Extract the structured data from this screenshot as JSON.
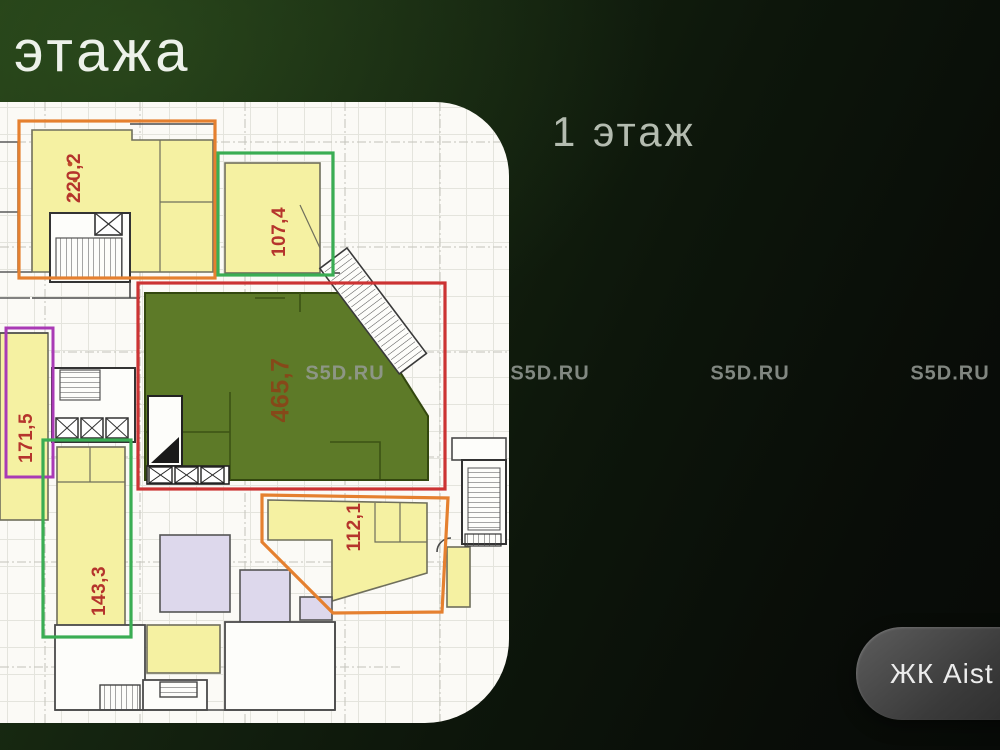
{
  "slide": {
    "title": "этажа",
    "floor_heading": "1 этаж"
  },
  "watermark": {
    "text": "S5D.RU"
  },
  "cta": {
    "label": "ЖК Aist"
  },
  "plan": {
    "units": [
      {
        "id": "unit-220",
        "area": "220,2",
        "outline_color": "#e5802f",
        "fill": "#f5f1a2"
      },
      {
        "id": "unit-107",
        "area": "107,4",
        "outline_color": "#3aad53",
        "fill": "#f5f1a2"
      },
      {
        "id": "unit-171",
        "area": "171,5",
        "outline_color": "#a93ab5",
        "fill": "#f5f1a2"
      },
      {
        "id": "unit-465",
        "area": "465,7",
        "outline_color": "#cc3333",
        "fill": "#5d7a28"
      },
      {
        "id": "unit-143",
        "area": "143,3",
        "outline_color": "#3aad53",
        "fill": "#f5f1a2"
      },
      {
        "id": "unit-112",
        "area": "112,1",
        "outline_color": "#e5802f",
        "fill": "#f5f1a2"
      }
    ]
  },
  "colors": {
    "background_green": "#1d3614",
    "plan_paper": "#fbfaf6",
    "unit_yellow": "#f5f1a2",
    "unit_olive": "#5d7a28",
    "lavender_room": "#ddd8ec",
    "area_label_red": "#b5342c",
    "accent_orange": "#e5802f",
    "accent_green": "#3aad53",
    "accent_red": "#cc3333",
    "accent_purple": "#a93ab5"
  }
}
